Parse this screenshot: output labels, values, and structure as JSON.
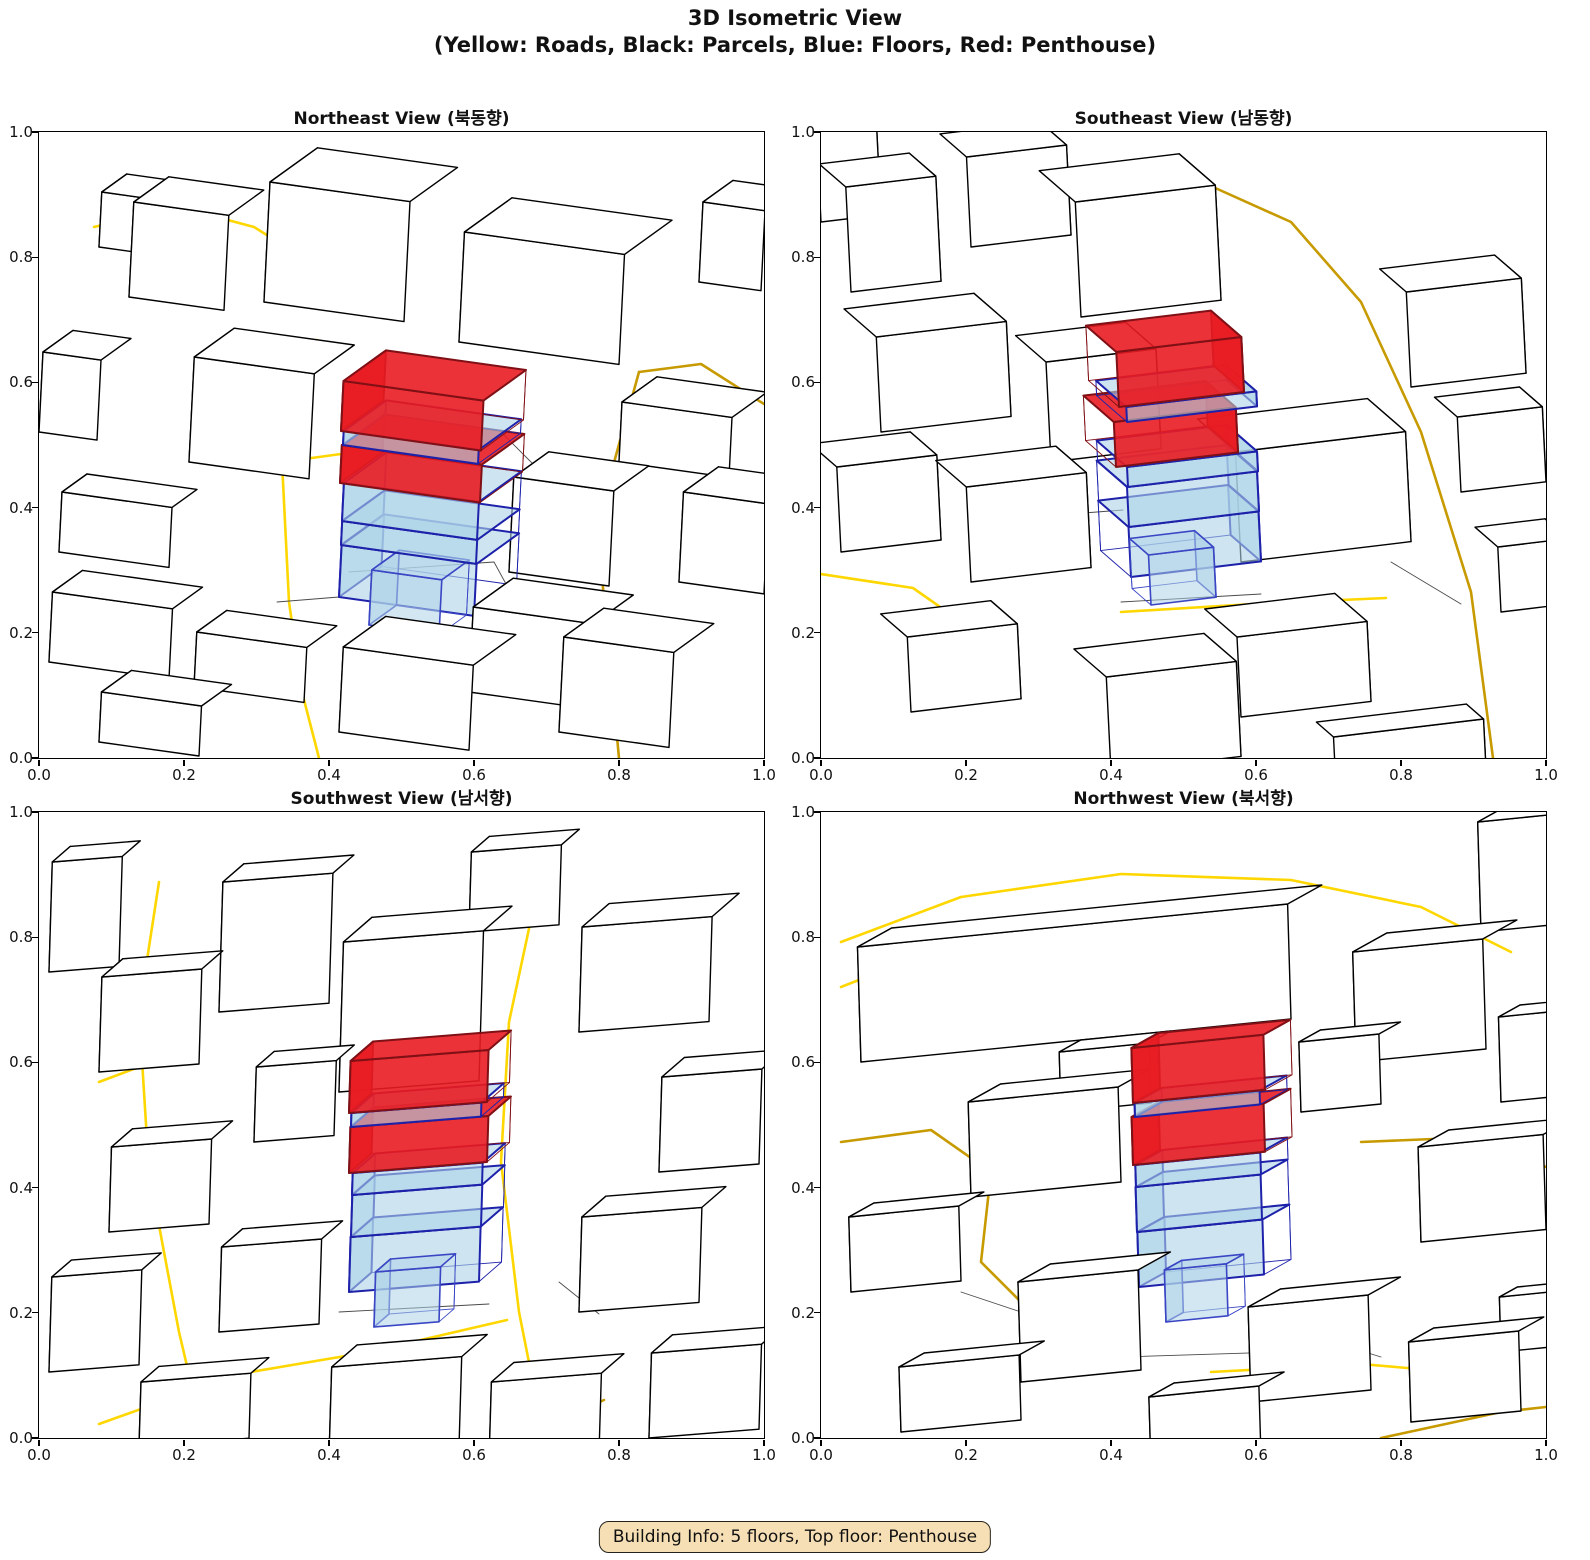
{
  "header": {
    "title_line1": "3D Isometric View",
    "title_line2": "(Yellow: Roads, Black: Parcels, Blue: Floors, Red: Penthouse)"
  },
  "footer": {
    "building_info": "Building Info: 5 floors, Top floor: Penthouse"
  },
  "axes": {
    "x_ticks": [
      "0.0",
      "0.2",
      "0.4",
      "0.6",
      "0.8",
      "1.0"
    ],
    "y_ticks": [
      "1.0",
      "0.8",
      "0.6",
      "0.4",
      "0.2",
      "0.0"
    ]
  },
  "panels": [
    {
      "title": "Northeast View (북동향)"
    },
    {
      "title": "Southeast View (남동향)"
    },
    {
      "title": "Southwest View (남서향)"
    },
    {
      "title": "Northwest View (북서향)"
    }
  ],
  "colors": {
    "road_gold": "#FFD700",
    "road_dark_gold": "#C79A00",
    "parcel_line": "#4a4a4a",
    "building_fill": "#ffffff",
    "building_edge": "#000000",
    "floor_fill": "#aed4e8",
    "floor_edge": "#1e22aa",
    "annex_edge": "#3a46c4",
    "penthouse_fill": "#e91c22",
    "penthouse_edge": "#7f1016",
    "info_bg": "#F6DFB4"
  },
  "chart_data": {
    "type": "3d_isometric_multiview",
    "figure_title": "3D Isometric View (Yellow: Roads, Black: Parcels, Blue: Floors, Red: Penthouse)",
    "legend": {
      "yellow": "Roads",
      "black": "Parcels",
      "blue": "Floors",
      "red": "Penthouse"
    },
    "views": [
      "Northeast View (북동향)",
      "Southeast View (남동향)",
      "Southwest View (남서향)",
      "Northwest View (북서향)"
    ],
    "axis_range": {
      "x": [
        0.0,
        1.0
      ],
      "y": [
        0.0,
        1.0
      ]
    },
    "ticks": [
      0.0,
      0.2,
      0.4,
      0.6,
      0.8,
      1.0
    ],
    "grid": false,
    "building": {
      "floors": 5,
      "top_floor": "Penthouse"
    }
  },
  "scenes": [
    {
      "side": "L",
      "u": [
        1,
        0.14
      ],
      "v": [
        0.5,
        -0.36
      ],
      "hx": 0.05,
      "roads": [
        {
          "c": "g",
          "p": [
            [
              55,
              95
            ],
            [
              140,
              75
            ],
            [
              215,
              95
            ],
            [
              242,
              112
            ]
          ]
        },
        {
          "c": "g",
          "p": [
            [
              278,
              208
            ],
            [
              243,
              330
            ],
            [
              250,
              470
            ],
            [
              263,
              560
            ],
            [
              280,
              626
            ]
          ]
        },
        {
          "c": "g",
          "p": [
            [
              243,
              330
            ],
            [
              302,
              322
            ]
          ]
        },
        {
          "c": "d",
          "p": [
            [
              600,
              240
            ],
            [
              558,
              392
            ],
            [
              580,
              626
            ]
          ]
        },
        {
          "c": "d",
          "p": [
            [
              600,
              240
            ],
            [
              662,
              232
            ],
            [
              725,
              272
            ]
          ]
        }
      ],
      "parcels": [
        [
          [
            310,
            440
          ],
          [
            455,
            430
          ],
          [
            478,
            472
          ]
        ],
        [
          [
            238,
            470
          ],
          [
            300,
            465
          ]
        ],
        [
          [
            462,
            300
          ],
          [
            524,
            362
          ]
        ]
      ],
      "boxes": [
        [
          60,
          115,
          60,
          50,
          55
        ],
        [
          90,
          165,
          95,
          70,
          95
        ],
        [
          660,
          150,
          62,
          60,
          80
        ],
        [
          225,
          170,
          140,
          95,
          120
        ],
        [
          420,
          210,
          160,
          95,
          110
        ],
        [
          0,
          300,
          58,
          60,
          80
        ],
        [
          150,
          330,
          120,
          80,
          105
        ],
        [
          580,
          330,
          110,
          70,
          60
        ],
        [
          20,
          420,
          110,
          50,
          60
        ],
        [
          470,
          440,
          100,
          70,
          95
        ],
        [
          640,
          450,
          85,
          70,
          90
        ],
        [
          10,
          530,
          120,
          60,
          70
        ],
        [
          300,
          465,
          135,
          85,
          52,
          "fl"
        ],
        [
          330,
          493,
          70,
          55,
          55,
          "fa"
        ],
        [
          302,
          413,
          135,
          85,
          24,
          "fl"
        ],
        [
          303,
          389,
          135,
          85,
          38,
          "fl"
        ],
        [
          301,
          351,
          140,
          85,
          38,
          "pe"
        ],
        [
          304,
          313,
          135,
          85,
          14,
          "fl"
        ],
        [
          302,
          299,
          140,
          85,
          50,
          "pe"
        ],
        [
          430,
          560,
          120,
          80,
          85
        ],
        [
          155,
          555,
          110,
          60,
          55
        ],
        [
          300,
          600,
          130,
          85,
          85
        ],
        [
          520,
          600,
          110,
          80,
          95
        ],
        [
          60,
          610,
          100,
          60,
          50
        ]
      ]
    },
    {
      "side": "R",
      "u": [
        1,
        -0.12
      ],
      "v": [
        -0.38,
        -0.33
      ],
      "hx": -0.05,
      "roads": [
        {
          "c": "g",
          "p": [
            [
              340,
              62
            ],
            [
              392,
              55
            ]
          ]
        },
        {
          "c": "d",
          "p": [
            [
              392,
              55
            ],
            [
              470,
              90
            ],
            [
              540,
              170
            ],
            [
              600,
              300
            ],
            [
              650,
              460
            ],
            [
              672,
              626
            ]
          ]
        },
        {
          "c": "d",
          "p": [
            [
              180,
              332
            ],
            [
              262,
              325
            ]
          ]
        },
        {
          "c": "g",
          "p": [
            [
              0,
              442
            ],
            [
              92,
              456
            ],
            [
              172,
              512
            ]
          ]
        },
        {
          "c": "g",
          "p": [
            [
              300,
              480
            ],
            [
              432,
              472
            ],
            [
              565,
              466
            ]
          ]
        }
      ],
      "parcels": [
        [
          [
            300,
            470
          ],
          [
            440,
            462
          ]
        ],
        [
          [
            250,
            382
          ],
          [
            302,
            378
          ]
        ],
        [
          [
            570,
            430
          ],
          [
            640,
            472
          ]
        ]
      ],
      "boxes": [
        [
          0,
          90,
          60,
          50,
          120
        ],
        [
          150,
          115,
          100,
          70,
          90
        ],
        [
          30,
          160,
          90,
          70,
          105
        ],
        [
          260,
          185,
          140,
          95,
          115
        ],
        [
          590,
          255,
          115,
          70,
          95
        ],
        [
          60,
          300,
          130,
          85,
          95
        ],
        [
          230,
          330,
          110,
          80,
          100
        ],
        [
          420,
          430,
          170,
          100,
          110
        ],
        [
          640,
          360,
          85,
          60,
          75
        ],
        [
          20,
          420,
          100,
          70,
          85
        ],
        [
          150,
          450,
          120,
          80,
          95
        ],
        [
          310,
          445,
          130,
          80,
          50,
          "fl"
        ],
        [
          330,
          473,
          65,
          50,
          50,
          "fa"
        ],
        [
          308,
          395,
          130,
          80,
          40,
          "fl"
        ],
        [
          307,
          355,
          130,
          80,
          20,
          "fl"
        ],
        [
          295,
          335,
          122,
          80,
          45,
          "pe"
        ],
        [
          306,
          290,
          130,
          80,
          15,
          "fl"
        ],
        [
          298,
          275,
          125,
          80,
          55,
          "pe"
        ],
        [
          420,
          585,
          130,
          85,
          80
        ],
        [
          90,
          580,
          110,
          70,
          75
        ],
        [
          290,
          640,
          130,
          85,
          95
        ],
        [
          515,
          655,
          150,
          45,
          50
        ],
        [
          680,
          480,
          70,
          60,
          65
        ]
      ]
    },
    {
      "side": "L",
      "u": [
        1,
        -0.08
      ],
      "v": [
        0.3,
        -0.26
      ],
      "hx": 0.03,
      "roads": [
        {
          "c": "g",
          "p": [
            [
              120,
              70
            ],
            [
              100,
              200
            ],
            [
              110,
              360
            ],
            [
              140,
              520
            ],
            [
              165,
              626
            ]
          ]
        },
        {
          "c": "g",
          "p": [
            [
              500,
              70
            ],
            [
              470,
              210
            ],
            [
              462,
              350
            ],
            [
              480,
              500
            ],
            [
              505,
              626
            ]
          ]
        },
        {
          "c": "g",
          "p": [
            [
              60,
              612
            ],
            [
              200,
              562
            ],
            [
              330,
              540
            ],
            [
              468,
              508
            ]
          ]
        },
        {
          "c": "g",
          "p": [
            [
              60,
              270
            ],
            [
              100,
              255
            ]
          ]
        },
        {
          "c": "d",
          "p": [
            [
              480,
              626
            ],
            [
              565,
              588
            ]
          ]
        }
      ],
      "parcels": [
        [
          [
            300,
            500
          ],
          [
            450,
            492
          ]
        ],
        [
          [
            200,
            420
          ],
          [
            252,
            415
          ]
        ],
        [
          [
            520,
            470
          ],
          [
            560,
            502
          ]
        ]
      ],
      "boxes": [
        [
          10,
          160,
          70,
          60,
          110
        ],
        [
          180,
          200,
          110,
          70,
          130
        ],
        [
          430,
          120,
          90,
          60,
          80
        ],
        [
          540,
          220,
          130,
          90,
          105
        ],
        [
          60,
          260,
          100,
          70,
          95
        ],
        [
          300,
          280,
          140,
          95,
          150
        ],
        [
          215,
          330,
          80,
          60,
          75
        ],
        [
          620,
          360,
          100,
          75,
          95
        ],
        [
          70,
          420,
          100,
          70,
          85
        ],
        [
          310,
          480,
          130,
          75,
          55,
          "fl"
        ],
        [
          335,
          515,
          65,
          50,
          55,
          "fa"
        ],
        [
          312,
          425,
          130,
          75,
          42,
          "fl"
        ],
        [
          313,
          383,
          130,
          75,
          22,
          "fl"
        ],
        [
          310,
          361,
          138,
          75,
          46,
          "pe"
        ],
        [
          312,
          315,
          130,
          75,
          14,
          "fl"
        ],
        [
          310,
          301,
          138,
          75,
          52,
          "pe"
        ],
        [
          180,
          520,
          100,
          70,
          85
        ],
        [
          540,
          500,
          120,
          80,
          95
        ],
        [
          10,
          560,
          90,
          65,
          95
        ],
        [
          610,
          626,
          110,
          70,
          85
        ],
        [
          290,
          645,
          130,
          85,
          90
        ],
        [
          450,
          650,
          110,
          75,
          80
        ],
        [
          100,
          635,
          110,
          60,
          65
        ]
      ]
    },
    {
      "side": "L",
      "u": [
        1,
        -0.1
      ],
      "v": [
        0.36,
        -0.2
      ],
      "hx": -0.03,
      "roads": [
        {
          "c": "g",
          "p": [
            [
              20,
              130
            ],
            [
              140,
              85
            ],
            [
              300,
              62
            ],
            [
              470,
              68
            ],
            [
              600,
              95
            ],
            [
              690,
              140
            ]
          ]
        },
        {
          "c": "g",
          "p": [
            [
              20,
              175
            ],
            [
              160,
              120
            ],
            [
              330,
              100
            ],
            [
              382,
              97
            ]
          ]
        },
        {
          "c": "d",
          "p": [
            [
              20,
              330
            ],
            [
              110,
              318
            ],
            [
              170,
              360
            ],
            [
              160,
              450
            ],
            [
              230,
              520
            ]
          ]
        },
        {
          "c": "d",
          "p": [
            [
              540,
              330
            ],
            [
              660,
              325
            ],
            [
              725,
              355
            ]
          ]
        },
        {
          "c": "g",
          "p": [
            [
              390,
              560
            ],
            [
              540,
              552
            ],
            [
              690,
              565
            ]
          ]
        },
        {
          "c": "d",
          "p": [
            [
              560,
              626
            ],
            [
              680,
              600
            ],
            [
              725,
              595
            ]
          ]
        }
      ],
      "parcels": [
        [
          [
            300,
            545
          ],
          [
            460,
            540
          ]
        ],
        [
          [
            480,
            520
          ],
          [
            560,
            545
          ]
        ],
        [
          [
            140,
            480
          ],
          [
            200,
            500
          ]
        ]
      ],
      "boxes": [
        [
          660,
          120,
          70,
          90,
          110
        ],
        [
          40,
          250,
          430,
          95,
          115
        ],
        [
          535,
          250,
          130,
          95,
          110
        ],
        [
          680,
          290,
          60,
          60,
          85
        ],
        [
          240,
          300,
          90,
          60,
          60
        ],
        [
          480,
          300,
          80,
          60,
          70
        ],
        [
          150,
          385,
          150,
          90,
          95
        ],
        [
          600,
          430,
          125,
          85,
          95
        ],
        [
          30,
          480,
          110,
          70,
          75
        ],
        [
          318,
          475,
          125,
          75,
          55,
          "fl"
        ],
        [
          345,
          510,
          62,
          48,
          52,
          "fa"
        ],
        [
          316,
          420,
          125,
          75,
          45,
          "fl"
        ],
        [
          315,
          375,
          125,
          75,
          22,
          "fl"
        ],
        [
          312,
          353,
          132,
          75,
          48,
          "pe"
        ],
        [
          314,
          305,
          125,
          75,
          14,
          "fl"
        ],
        [
          312,
          291,
          132,
          75,
          55,
          "pe"
        ],
        [
          200,
          570,
          120,
          90,
          100
        ],
        [
          430,
          590,
          120,
          90,
          95
        ],
        [
          680,
          540,
          60,
          50,
          55
        ],
        [
          590,
          610,
          110,
          70,
          80
        ],
        [
          80,
          620,
          120,
          70,
          65
        ],
        [
          330,
          655,
          110,
          70,
          70
        ]
      ]
    }
  ]
}
